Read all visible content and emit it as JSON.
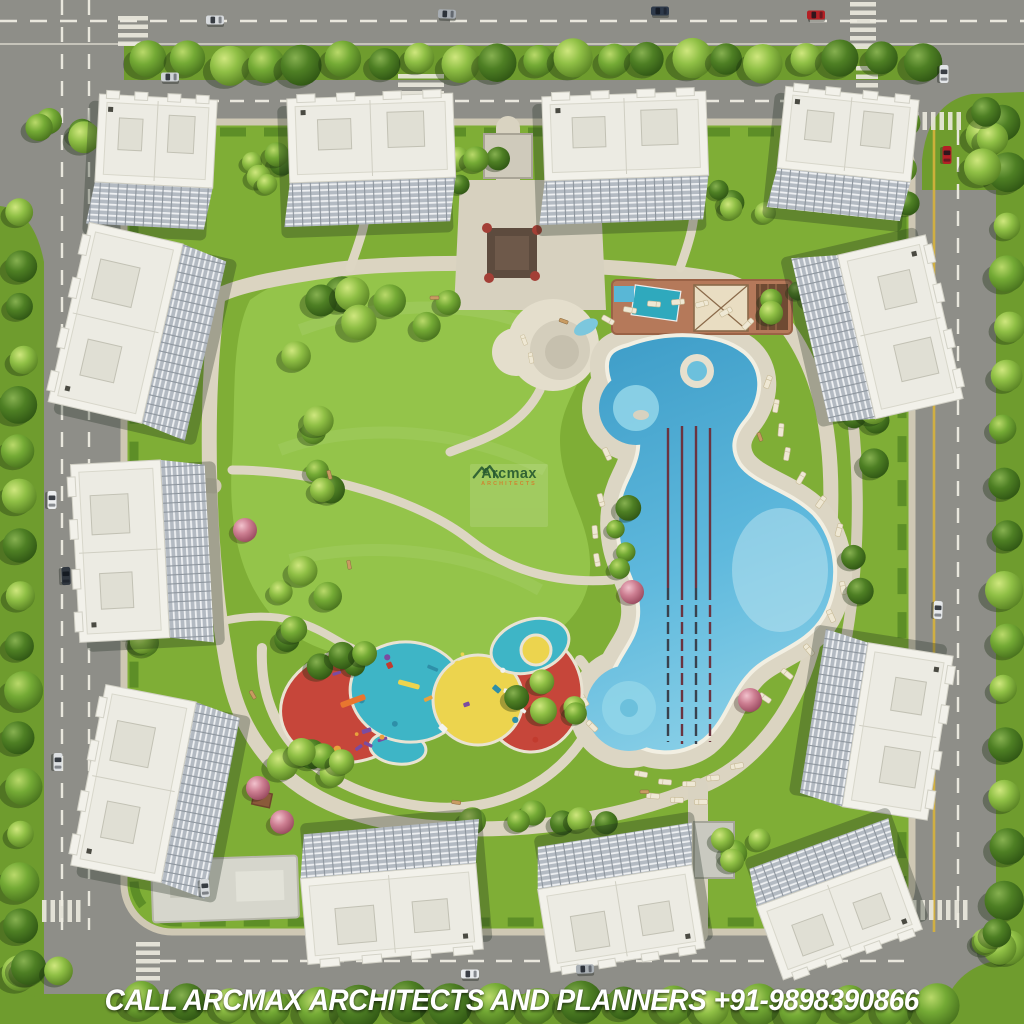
{
  "image": {
    "type": "aerial architectural master-plan render",
    "subject": "residential apartment complex with central park, free-form swimming pool and playground"
  },
  "watermark": {
    "brand": "Arcmax",
    "subtitle": "ARCHITECTS"
  },
  "caption": {
    "text": "CALL ARCMAX ARCHITECTS AND PLANNERS +91-9898390866",
    "phone": "+91-9898390866"
  },
  "scene": {
    "counts": {
      "apartment_towers": 12,
      "pool_lap_lanes": 4
    },
    "features": [
      "perimeter roads with tree-lined verges and zebra crossings",
      "large central lawn with looping walking paths",
      "free-form swimming pool with four lap lanes and two round kids pools",
      "terracotta pool deck with cabana and sun loungers",
      "round fountain plaza",
      "children playground with red, cyan and yellow safety surfacing",
      "entrance plazas and clubhouse",
      "cars on surrounding roads"
    ],
    "colors": {
      "grass_outer": "#6f9c2e",
      "grass_campus": "#7fae36",
      "lawn": "#94c44a",
      "road": "#8e8e88",
      "paving": "#d9d3c1",
      "pool_water": "#54b2d8",
      "pool_water_light": "#9fd9ea",
      "pool_deck": "#b5795a",
      "lane_rope": "#6b3440",
      "playground_red": "#c6463a",
      "playground_cyan": "#3eb5c6",
      "playground_yellow": "#ecd44e",
      "building_roof": "#f2f1ea",
      "building_facade": "#b3bac2",
      "tree_green": "#5f9427",
      "flowering_tree": "#c9768c",
      "road_line_white": "#e9e7dd",
      "road_line_yellow": "#d7b23c",
      "car_red": "#b42025",
      "caption_text": "#ffffff",
      "watermark_green": "#1c5132",
      "watermark_orange": "#d97b2c"
    }
  }
}
